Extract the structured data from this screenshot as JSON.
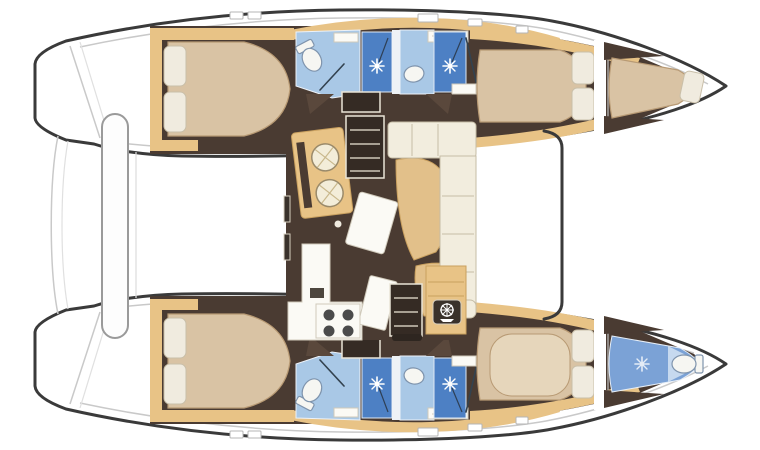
{
  "vessel": {
    "type": "catamaran-sailing-yacht-interior-floorplan",
    "view": "top-down",
    "bow_direction": "right",
    "hull_count": 2
  },
  "port_hull": {
    "position": "top",
    "rooms": [
      {
        "name": "aft-double-cabin",
        "furniture": [
          "island-double-bed",
          "pillow",
          "pillow",
          "wood-trim"
        ]
      },
      {
        "name": "aft-head",
        "fixtures": [
          "toilet",
          "shower-stall"
        ]
      },
      {
        "name": "forward-head",
        "fixtures": [
          "washbasin",
          "shower-stall"
        ]
      },
      {
        "name": "forward-double-cabin",
        "furniture": [
          "double-bed",
          "pillow",
          "pillow"
        ]
      },
      {
        "name": "bow-berth",
        "furniture": [
          "single-berth",
          "pillow"
        ]
      }
    ]
  },
  "starboard_hull": {
    "position": "bottom",
    "rooms": [
      {
        "name": "aft-double-cabin",
        "furniture": [
          "island-double-bed",
          "pillow",
          "pillow",
          "wood-trim"
        ]
      },
      {
        "name": "aft-head",
        "fixtures": [
          "toilet",
          "shower-stall"
        ]
      },
      {
        "name": "forward-head",
        "fixtures": [
          "washbasin",
          "shower-stall"
        ]
      },
      {
        "name": "forward-double-cabin",
        "furniture": [
          "double-bed",
          "pillow",
          "pillow"
        ]
      },
      {
        "name": "bow-head",
        "fixtures": [
          "toilet",
          "shower"
        ]
      }
    ]
  },
  "bridgedeck_saloon": {
    "position": "center",
    "features": [
      {
        "name": "galley-sink-unit",
        "fixtures": [
          "round-sink",
          "round-sink"
        ]
      },
      {
        "name": "port-companionway-steps"
      },
      {
        "name": "l-shaped-settee"
      },
      {
        "name": "curved-dining-table"
      },
      {
        "name": "movable-coffee-table"
      },
      {
        "name": "galley-counter"
      },
      {
        "name": "four-burner-stove"
      },
      {
        "name": "starboard-companionway-steps"
      },
      {
        "name": "nav-cabinet",
        "badge": "helm-wheel-icon"
      }
    ]
  },
  "exterior": {
    "aft": [
      "port-transom-steps",
      "starboard-transom-steps",
      "aft-cockpit-bench"
    ],
    "forward": [
      "foredeck",
      "coachroof-front-edge"
    ],
    "deck": [
      "deck-hatches"
    ]
  },
  "icons": [
    "toilet-icon",
    "shower-spray-icon",
    "washbasin-icon",
    "stove-burner-icon",
    "helm-wheel-icon",
    "stairs-icon",
    "pillow-icon"
  ],
  "colors": {
    "outline": "#3a3a3a",
    "deck_line": "#c9c9c9",
    "floor": "#4a3b32",
    "floor_light": "#5a483c",
    "wood": "#e8c386",
    "wood_dark": "#c9a05f",
    "bed": "#d9c3a4",
    "bed_edge": "#b89a74",
    "bed_light": "#e6d6bb",
    "pillow": "#f0ebdf",
    "pillow_edge": "#c9bfa9",
    "bath_light": "#a9c8e6",
    "bath_mid": "#4d80c4",
    "bath_bow": "#7ba2d6",
    "bath_bow_light": "#c6d9ef",
    "fixture_white": "#f6f6f2",
    "fixture_edge": "#7f94ad",
    "counter": "#fbfaf5",
    "counter_edge": "#d0cabb",
    "settee": "#f2edde",
    "settee_edge": "#c6bda6",
    "table": "#e2c08a",
    "stairs": "#352b24",
    "stair_line": "#cfc8b8",
    "burner": "#4b4b4b",
    "badge": "#3a322b"
  }
}
